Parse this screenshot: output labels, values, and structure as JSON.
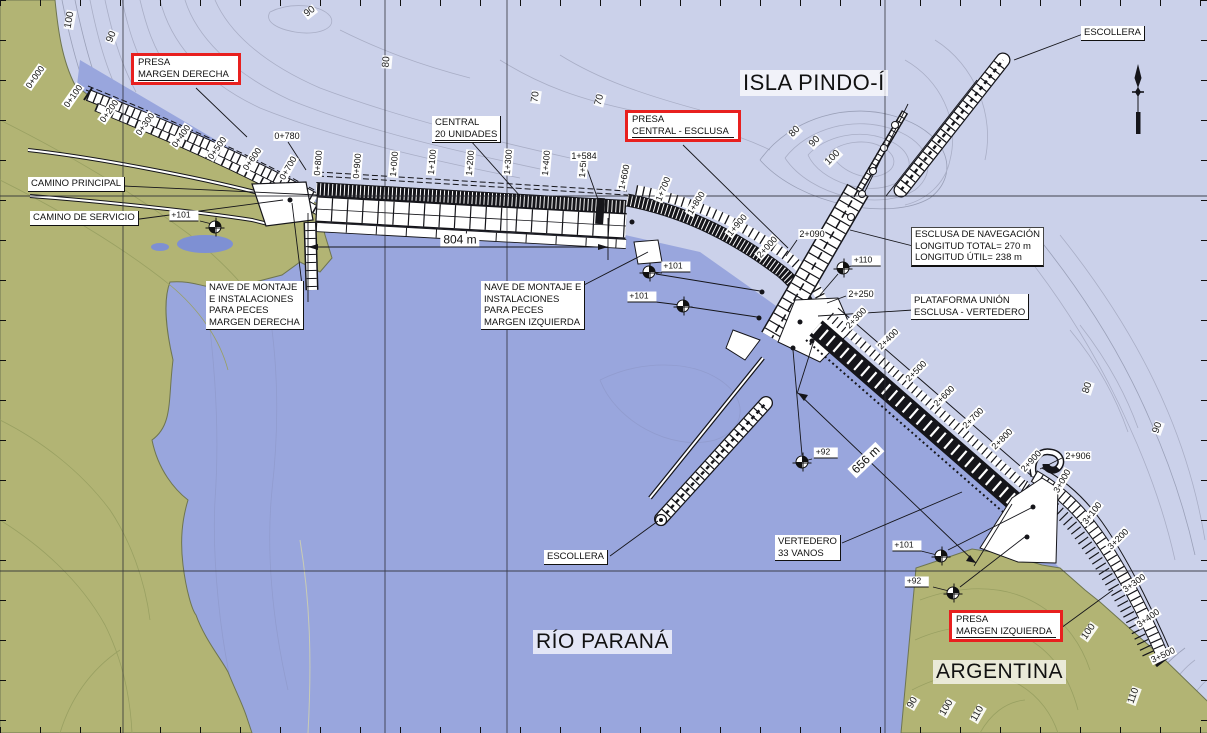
{
  "colors": {
    "light": "#cbd1ea",
    "water": "#99a6dd",
    "deepwater": "#7e90d3",
    "land": "#b2b474",
    "red": "#e8201f",
    "ink": "#15151a"
  },
  "map": {
    "region_labels": {
      "isla": "ISLA PINDO-Í",
      "rio": "RÍO PARANÁ",
      "argentina": "ARGENTINA"
    },
    "callouts": {
      "camino_principal": {
        "lines": [
          "CAMINO PRINCIPAL"
        ]
      },
      "camino_servicio": {
        "lines": [
          "CAMINO DE SERVICIO"
        ]
      },
      "central": {
        "lines": [
          "CENTRAL",
          "20 UNIDADES"
        ]
      },
      "presa_margen_derecha": {
        "lines": [
          "PRESA",
          "MARGEN DERECHA"
        ]
      },
      "presa_central_esclusa": {
        "lines": [
          "PRESA",
          "CENTRAL - ESCLUSA"
        ]
      },
      "presa_margen_izquierda": {
        "lines": [
          "PRESA",
          "MARGEN IZQUIERDA"
        ]
      },
      "escollera_norte": {
        "lines": [
          "ESCOLLERA"
        ]
      },
      "escollera_sur": {
        "lines": [
          "ESCOLLERA"
        ]
      },
      "esclusa_info": {
        "lines": [
          "ESCLUSA DE NAVEGACIÓN",
          "LONGITUD TOTAL= 270 m",
          "LONGITUD ÚTIL= 238 m"
        ]
      },
      "plataforma": {
        "lines": [
          "PLATAFORMA UNIÓN",
          "ESCLUSA - VERTEDERO"
        ]
      },
      "nave_derecha": {
        "lines": [
          "NAVE DE MONTAJE",
          "E INSTALACIONES",
          "PARA PECES",
          "MARGEN DERECHA"
        ]
      },
      "nave_izquierda": {
        "lines": [
          "NAVE DE MONTAJE E",
          "INSTALACIONES",
          "PARA PECES",
          "MARGEN IZQUIERDA"
        ]
      },
      "vertedero": {
        "lines": [
          "VERTEDERO",
          "33 VANOS"
        ]
      }
    },
    "dimensions": [
      {
        "label": "804 m",
        "x": 460,
        "y": 240,
        "r": 0
      },
      {
        "label": "656 m",
        "x": 866,
        "y": 460,
        "r": -44
      }
    ],
    "chainage_labels": [
      {
        "t": "0+000",
        "x": 35,
        "y": 77,
        "r": -55
      },
      {
        "t": "0+100",
        "x": 73,
        "y": 96,
        "r": -55
      },
      {
        "t": "0+200",
        "x": 109,
        "y": 111,
        "r": -55
      },
      {
        "t": "0+300",
        "x": 145,
        "y": 124,
        "r": -55
      },
      {
        "t": "0+400",
        "x": 181,
        "y": 136,
        "r": -55
      },
      {
        "t": "0+500",
        "x": 217,
        "y": 148,
        "r": -55
      },
      {
        "t": "0+600",
        "x": 252,
        "y": 159,
        "r": -55
      },
      {
        "t": "0+700",
        "x": 288,
        "y": 168,
        "r": -60
      },
      {
        "t": "0+780",
        "x": 287,
        "y": 136,
        "r": 0
      },
      {
        "t": "0+800",
        "x": 318,
        "y": 163,
        "r": -85
      },
      {
        "t": "0+900",
        "x": 357,
        "y": 166,
        "r": -85
      },
      {
        "t": "1+000",
        "x": 394,
        "y": 164,
        "r": -85
      },
      {
        "t": "1+100",
        "x": 432,
        "y": 162,
        "r": -85
      },
      {
        "t": "1+200",
        "x": 470,
        "y": 163,
        "r": -85
      },
      {
        "t": "1+300",
        "x": 508,
        "y": 162,
        "r": -85
      },
      {
        "t": "1+400",
        "x": 546,
        "y": 163,
        "r": -85
      },
      {
        "t": "1+500",
        "x": 583,
        "y": 165,
        "r": -85
      },
      {
        "t": "1+584",
        "x": 584,
        "y": 156,
        "r": 0
      },
      {
        "t": "1+600",
        "x": 624,
        "y": 177,
        "r": -78
      },
      {
        "t": "1+700",
        "x": 663,
        "y": 189,
        "r": -68
      },
      {
        "t": "1+800",
        "x": 696,
        "y": 203,
        "r": -58
      },
      {
        "t": "1+900",
        "x": 737,
        "y": 225,
        "r": -50
      },
      {
        "t": "2+000",
        "x": 767,
        "y": 247,
        "r": -48
      },
      {
        "t": "2+090",
        "x": 812,
        "y": 234,
        "r": 0
      },
      {
        "t": "2+250",
        "x": 861,
        "y": 294,
        "r": 0
      },
      {
        "t": "2+300",
        "x": 856,
        "y": 318,
        "r": -46
      },
      {
        "t": "2+400",
        "x": 888,
        "y": 339,
        "r": -45
      },
      {
        "t": "2+500",
        "x": 916,
        "y": 371,
        "r": -45
      },
      {
        "t": "2+600",
        "x": 944,
        "y": 396,
        "r": -45
      },
      {
        "t": "2+700",
        "x": 973,
        "y": 418,
        "r": -45
      },
      {
        "t": "2+800",
        "x": 1002,
        "y": 439,
        "r": -45
      },
      {
        "t": "2+900",
        "x": 1031,
        "y": 461,
        "r": -48
      },
      {
        "t": "2+906",
        "x": 1078,
        "y": 456,
        "r": 0
      },
      {
        "t": "3+000",
        "x": 1062,
        "y": 481,
        "r": -60
      },
      {
        "t": "3+100",
        "x": 1092,
        "y": 513,
        "r": -52
      },
      {
        "t": "3+200",
        "x": 1118,
        "y": 539,
        "r": -45
      },
      {
        "t": "3+300",
        "x": 1134,
        "y": 583,
        "r": -35
      },
      {
        "t": "3+400",
        "x": 1148,
        "y": 618,
        "r": -35
      },
      {
        "t": "3+500",
        "x": 1163,
        "y": 655,
        "r": -25
      }
    ],
    "contour_labels": [
      {
        "t": "100",
        "x": 70,
        "y": 20,
        "r": -80
      },
      {
        "t": "90",
        "x": 112,
        "y": 37,
        "r": -68
      },
      {
        "t": "90",
        "x": 310,
        "y": 12,
        "r": -38
      },
      {
        "t": "80",
        "x": 387,
        "y": 62,
        "r": -85
      },
      {
        "t": "70",
        "x": 536,
        "y": 97,
        "r": -82
      },
      {
        "t": "70",
        "x": 600,
        "y": 100,
        "r": -75
      },
      {
        "t": "80",
        "x": 795,
        "y": 132,
        "r": -45
      },
      {
        "t": "90",
        "x": 815,
        "y": 142,
        "r": -45
      },
      {
        "t": "100",
        "x": 833,
        "y": 158,
        "r": -45
      },
      {
        "t": "80",
        "x": 1088,
        "y": 388,
        "r": -72
      },
      {
        "t": "90",
        "x": 1158,
        "y": 428,
        "r": -70
      },
      {
        "t": "100",
        "x": 1089,
        "y": 632,
        "r": -55
      },
      {
        "t": "110",
        "x": 1134,
        "y": 696,
        "r": -70
      },
      {
        "t": "90",
        "x": 913,
        "y": 703,
        "r": -60
      },
      {
        "t": "100",
        "x": 947,
        "y": 708,
        "r": -60
      },
      {
        "t": "110",
        "x": 978,
        "y": 714,
        "r": -60
      }
    ],
    "spot_elevations": [
      {
        "value": "+101",
        "label_x": 184,
        "label_y": 216,
        "marker_x": 215,
        "marker_y": 227
      },
      {
        "value": "+101",
        "label_x": 676,
        "label_y": 267,
        "marker_x": 649,
        "marker_y": 272
      },
      {
        "value": "+101",
        "label_x": 642,
        "label_y": 297,
        "marker_x": 683,
        "marker_y": 306
      },
      {
        "value": "+110",
        "label_x": 866,
        "label_y": 261,
        "marker_x": 843,
        "marker_y": 268
      },
      {
        "value": "+92",
        "label_x": 826,
        "label_y": 453,
        "marker_x": 802,
        "marker_y": 462
      },
      {
        "value": "+101",
        "label_x": 907,
        "label_y": 546,
        "marker_x": 941,
        "marker_y": 556
      },
      {
        "value": "+92",
        "label_x": 917,
        "label_y": 582,
        "marker_x": 953,
        "marker_y": 593
      }
    ]
  }
}
